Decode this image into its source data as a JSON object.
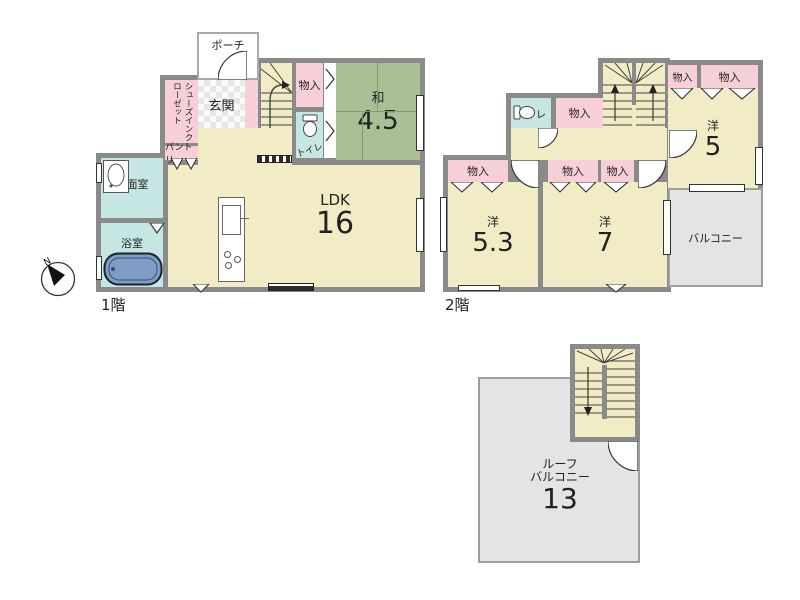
{
  "compass": {
    "north_label": "N"
  },
  "floor1": {
    "floor_label": "1階",
    "porch": "ポーチ",
    "genkan": "玄関",
    "shoes_in_closet": "シューズインクローゼット",
    "pantry": "パントリー",
    "storage": "物入",
    "toilet": "トイレ",
    "washroom": "洗面室",
    "bathroom": "浴室",
    "japanese_room_name": "和",
    "japanese_room_size": "4.5",
    "ldk_name": "LDK",
    "ldk_size": "16"
  },
  "floor2": {
    "floor_label": "2階",
    "toilet": "トイレ",
    "storage": "物入",
    "room5_name": "洋",
    "room5_size": "5",
    "room53_name": "洋",
    "room53_size": "5.3",
    "room7_name": "洋",
    "room7_size": "7",
    "balcony": "バルコニー"
  },
  "roof": {
    "name_line1": "ルーフ",
    "name_line2": "バルコニー",
    "size": "13"
  },
  "colors": {
    "wall": "#8a8a8a",
    "floor_yellow": "#f1ecc5",
    "closet_pink": "#f7cfd6",
    "wet_blue": "#c6e6e4",
    "tatami_green": "#a9bf96",
    "balcony_gray": "#e4e4e4",
    "tub_blue": "#7e9cc4"
  }
}
